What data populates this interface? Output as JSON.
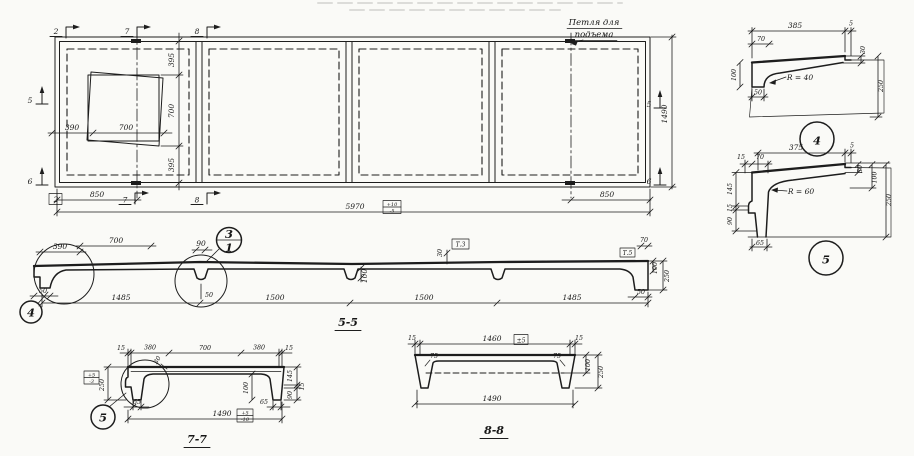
{
  "plan": {
    "lifting_loop_line1": "Петля для",
    "lifting_loop_line2": "подъема",
    "markers": {
      "top2": "2",
      "top7": "7",
      "top8": "8",
      "bot2": "2",
      "bot7": "7",
      "bot8": "8",
      "left5": "5",
      "left6": "6",
      "right5": "5",
      "right6": "6"
    },
    "dims": {
      "v395_top": "395",
      "v700": "700",
      "v395_bot": "395",
      "h390": "390",
      "h700": "700",
      "b850_left": "850",
      "b850_right": "850",
      "length": "5970",
      "length_tol_plus": "+10",
      "length_tol_minus": "-5",
      "width": "1490"
    }
  },
  "s55": {
    "label": "5-5",
    "dims": {
      "d390": "390",
      "d700": "700",
      "d90": "90",
      "d50_left": "50",
      "d50_mid": "50",
      "d50_right": "50",
      "d30": "30",
      "d70": "70",
      "d100_mid": "100",
      "d100_right": "100",
      "d250": "250",
      "seg1": "1485",
      "seg2": "1500",
      "seg3": "1500",
      "seg4": "1485"
    },
    "boxes": {
      "t3": "Т.3",
      "t5": "Т.5"
    },
    "callouts": {
      "c4": "4",
      "c3": "3",
      "c1": "1"
    }
  },
  "d4": {
    "callout": "4",
    "radius": "R = 40",
    "dims": {
      "d385": "385",
      "d5": "5",
      "d70": "70",
      "d100": "100",
      "d50": "50",
      "d30": "30",
      "d250": "250"
    }
  },
  "d5": {
    "callout": "5",
    "radius": "R = 60",
    "dims": {
      "d375": "375",
      "d5": "5",
      "d15_top": "15",
      "d70": "70",
      "d145": "145",
      "d15_left": "15",
      "d90": "90",
      "d65": "65",
      "d30": "30",
      "d100": "100",
      "d250": "250"
    }
  },
  "s77": {
    "label": "7-7",
    "callout": "5",
    "dims": {
      "d15_l": "15",
      "d380_l": "380",
      "d700": "700",
      "d380_r": "380",
      "d15_r": "15",
      "d30": "30",
      "d250": "250",
      "d145": "145",
      "d15_edge": "15",
      "d90": "90",
      "d100": "100",
      "d65_l": "65",
      "d65_r": "65",
      "d1490": "1490"
    },
    "tol": {
      "h_plus": "+5",
      "h_minus": "-3",
      "w_plus": "+5",
      "w_minus": "-10"
    }
  },
  "s88": {
    "label": "8-8",
    "dims": {
      "d15_l": "15",
      "d1460": "1460",
      "d15_r": "15",
      "a75_l": "75",
      "a75_r": "75",
      "d100": "100",
      "d250": "250",
      "d1490": "1490"
    },
    "tol": {
      "w": "±5"
    }
  }
}
